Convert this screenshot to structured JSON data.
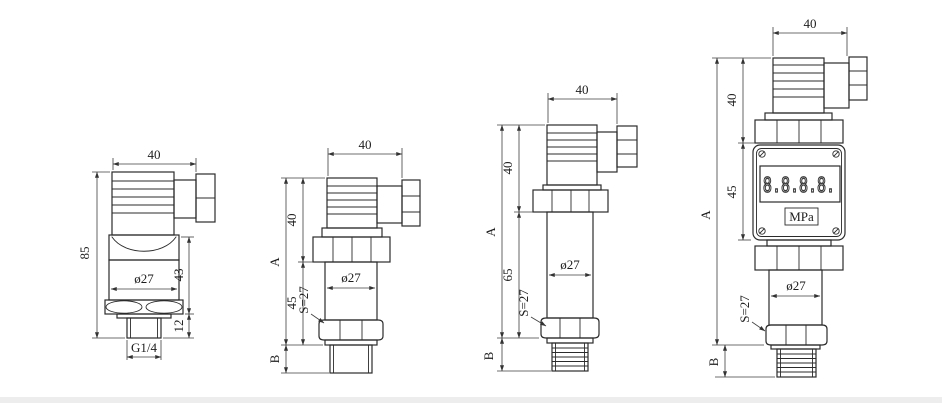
{
  "drawing": {
    "background": "#ffffff",
    "line_color": "#2b2b2b",
    "figures": [
      {
        "name": "transmitter-compact-g14",
        "dim_top_width": "40",
        "dim_total_height": "85",
        "dim_body_diameter": "ø27",
        "dim_body_height": "43",
        "dim_thread_length": "12",
        "dim_thread_spec": "G1/4"
      },
      {
        "name": "transmitter-standard-45",
        "dim_top_width": "40",
        "dim_total_height": "A",
        "dim_head_height": "40",
        "dim_body_height": "45",
        "dim_body_diameter": "ø27",
        "dim_hex_across_flats": "S=27",
        "dim_thread_length": "B"
      },
      {
        "name": "transmitter-long-65",
        "dim_top_width": "40",
        "dim_total_height": "A",
        "dim_head_height": "40",
        "dim_body_height": "65",
        "dim_body_diameter": "ø27",
        "dim_hex_across_flats": "S=27",
        "dim_thread_length": "B"
      },
      {
        "name": "transmitter-with-display",
        "dim_top_width": "40",
        "dim_total_height": "A",
        "dim_head_height": "40",
        "dim_display_height": "45",
        "dim_body_diameter": "ø27",
        "dim_hex_across_flats": "S=27",
        "dim_thread_length": "B",
        "display_digits": "8.8.8.8.",
        "display_unit": "MPa"
      }
    ]
  }
}
